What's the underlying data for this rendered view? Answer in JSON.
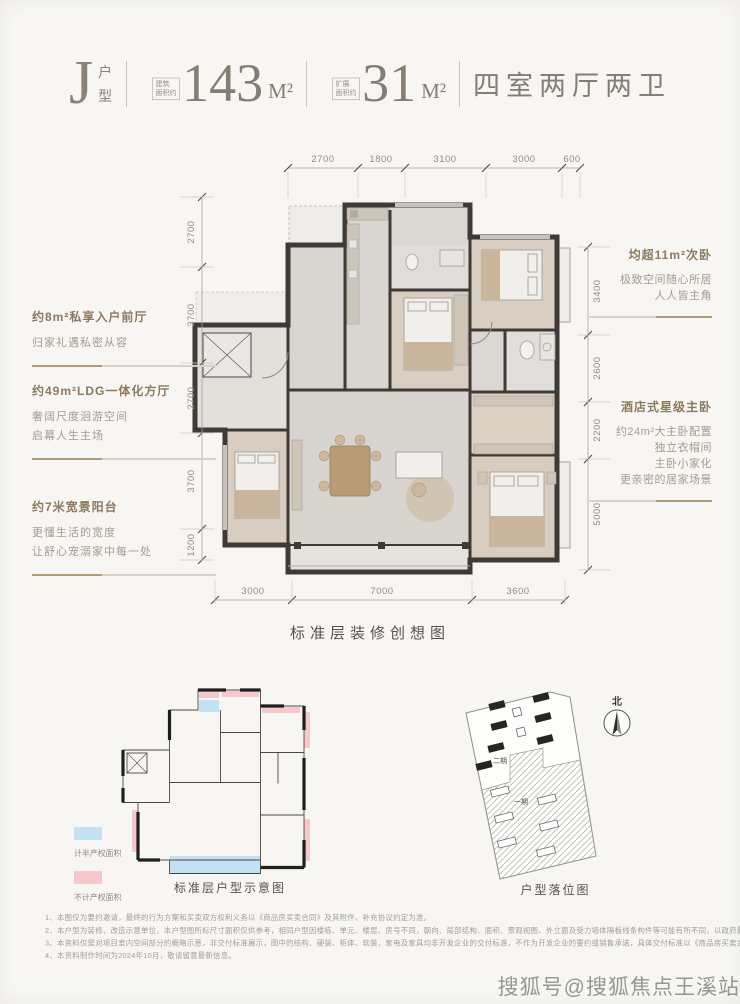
{
  "header": {
    "type_letter": "J",
    "type_char_1": "户",
    "type_char_2": "型",
    "area1_label_1": "建筑",
    "area1_label_2": "面积约",
    "area1_value": "143",
    "area1_unit": "M²",
    "area2_label_1": "扩展",
    "area2_label_2": "面积约",
    "area2_value": "31",
    "area2_unit": "M²",
    "rooms": "四室两厅两卫"
  },
  "dims": {
    "top": [
      "2700",
      "1800",
      "3100",
      "3000",
      "600"
    ],
    "left": [
      "2700",
      "3700",
      "2700",
      "3700",
      "1200"
    ],
    "right": [
      "3400",
      "2600",
      "2200",
      "5000"
    ],
    "bottom": [
      "3000",
      "7000",
      "3600"
    ]
  },
  "annotations": {
    "left": [
      {
        "title": "约8m²私享入户前厅",
        "lines": [
          "归家礼遇私密从容"
        ]
      },
      {
        "title": "约49m²LDG一体化方厅",
        "lines": [
          "奢阔尺度洄游空间",
          "启幕人生主场"
        ]
      },
      {
        "title": "约7米宽景阳台",
        "lines": [
          "更懂生活的宽度",
          "让舒心宠溺家中每一处"
        ]
      }
    ],
    "right": [
      {
        "title": "均超11m²次卧",
        "lines": [
          "极致空间随心所居",
          "人人皆主角"
        ]
      },
      {
        "title": "酒店式星级主卧",
        "lines": [
          "约24m²大主卧配置",
          "独立衣帽间",
          "主卧小家化",
          "更亲密的居家场景"
        ]
      }
    ]
  },
  "captions": {
    "main": "标准层装修创想图",
    "schematic": "标准层户型示意图",
    "site": "户型落位图"
  },
  "legend": {
    "half": {
      "label": "计半产权面积",
      "color": "#c2e2f3"
    },
    "excluded": {
      "label": "不计产权面积",
      "color": "#f6c8cc"
    }
  },
  "site": {
    "north": "北",
    "phase_2": "二期",
    "phase_1": "一期"
  },
  "colors": {
    "accent_tan": "#b29c77",
    "title_brown": "#8b7a5f",
    "header_gray": "#857d73"
  },
  "footnotes": [
    "1、本图仅为要约邀请，最终的行为方案和买卖双方权利义务以《商品房买卖合同》及其附件、补充协议约定为准。",
    "2、本户型为装修、改造示意单位，本户型图所标尺寸面积仅供参考，相同户型因楼栋、单元、楼层、房号不同，朝向、局部结构、面积、景观视图、外立面及受力墙体隔板线条构件等可能有所不同，以政府最终审批图纸及合同附图约定为准。",
    "3、本资料仅是对项目室内空间部分的概略示意，非交付标准展示，图中的结构、硬装、柜体、软装、家电及家具均非开发企业的交付标准，不作为开发企业的要约或销售承诺，具体交付标准以《商品房买卖合同》及其附件、补充协议约定为准。",
    "4、本资料制作时间为2024年10月，敬请留意最新信息。"
  ],
  "watermark": "搜狐号@搜狐焦点王溪站"
}
